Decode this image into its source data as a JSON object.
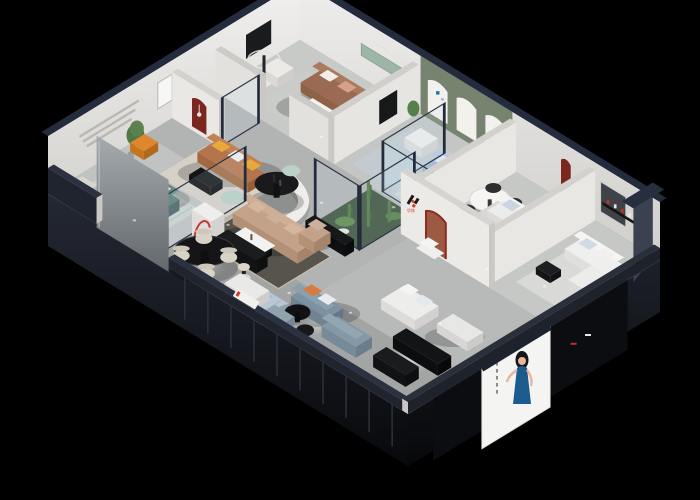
{
  "brand": {
    "letter": "H",
    "cjk": "华饰",
    "red": "#d23b2a",
    "dark": "#1b1b1b"
  },
  "wall_lettering": "······",
  "arch_badge": "M",
  "poster": {
    "bg": "#f4f4f2",
    "dress": "#1b5b8d",
    "skin": "#e9b69b",
    "hair": "#14161a"
  },
  "palette": {
    "background": "#000000",
    "wall_cap_navy": "#232b3c",
    "wall_white": "#e9e8e6",
    "green_wall": "#75836f",
    "mint_niche": "#9db5a5",
    "dark_red": "#7c2620",
    "terracotta": "#9c5a42",
    "caramel": "#b5754c",
    "teal": "#5e7b7a",
    "tan": "#c4a28a",
    "light_blue": "#a7bed6",
    "blue_grey": "#7d92a0",
    "orange": "#e0862e",
    "mint": "#bcd2c6",
    "yellow": "#e8a93c",
    "floor": "#b8bab9",
    "plant_green": "#4e7a42",
    "atrium_floor": "#3c5039"
  }
}
